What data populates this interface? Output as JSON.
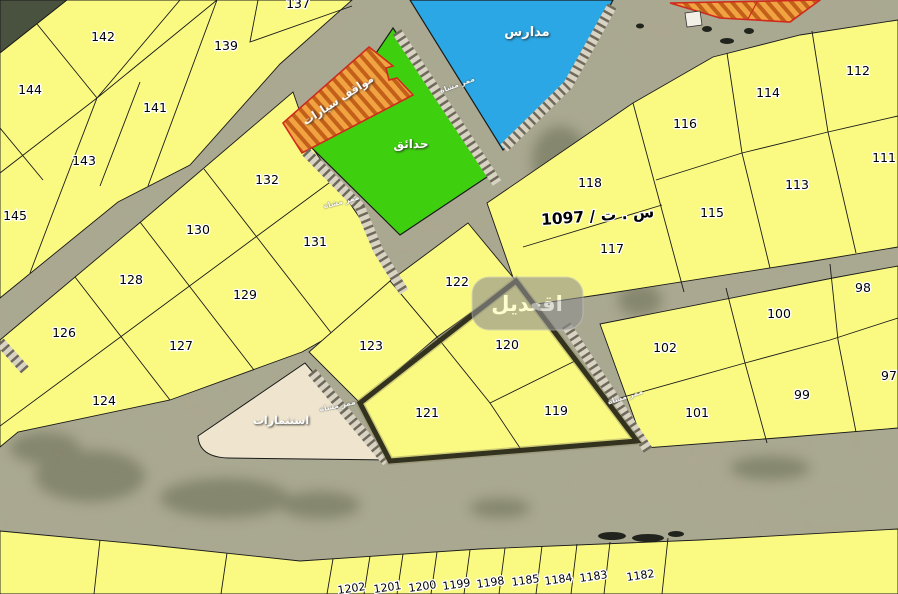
{
  "map": {
    "watermark": "اقعديل",
    "survey_ref": "س . ت / 1097",
    "zones": {
      "schools": "مدارس",
      "parks": "حدائق",
      "parking": "مواقف سيارات",
      "investments": "استثمارات",
      "walkway": "ممر مشاة"
    },
    "parcel_numbers": [
      "137",
      "142",
      "139",
      "144",
      "141",
      "143",
      "145",
      "132",
      "130",
      "131",
      "128",
      "129",
      "126",
      "127",
      "124",
      "122",
      "123",
      "120",
      "121",
      "119",
      "116",
      "114",
      "112",
      "118",
      "115",
      "113",
      "111",
      "117",
      "102",
      "100",
      "98",
      "101",
      "99",
      "97",
      "1202",
      "1201",
      "1200",
      "1199",
      "1198",
      "1185",
      "1184",
      "1183",
      "1182"
    ]
  },
  "colors": {
    "parcel_yellow": "#fafa82",
    "schools_blue": "#2aa7e4",
    "parks_green": "#3ed00e",
    "parking_orange": "#f2a341",
    "parking_stripe": "#c2601a",
    "parking_border": "#cf2a1d",
    "investments_beige": "#efe5ce",
    "terrain": "#b3a68d",
    "dark_area": "#49523f",
    "boundary": "#1a1a1a",
    "compound_border": "#32321e"
  }
}
